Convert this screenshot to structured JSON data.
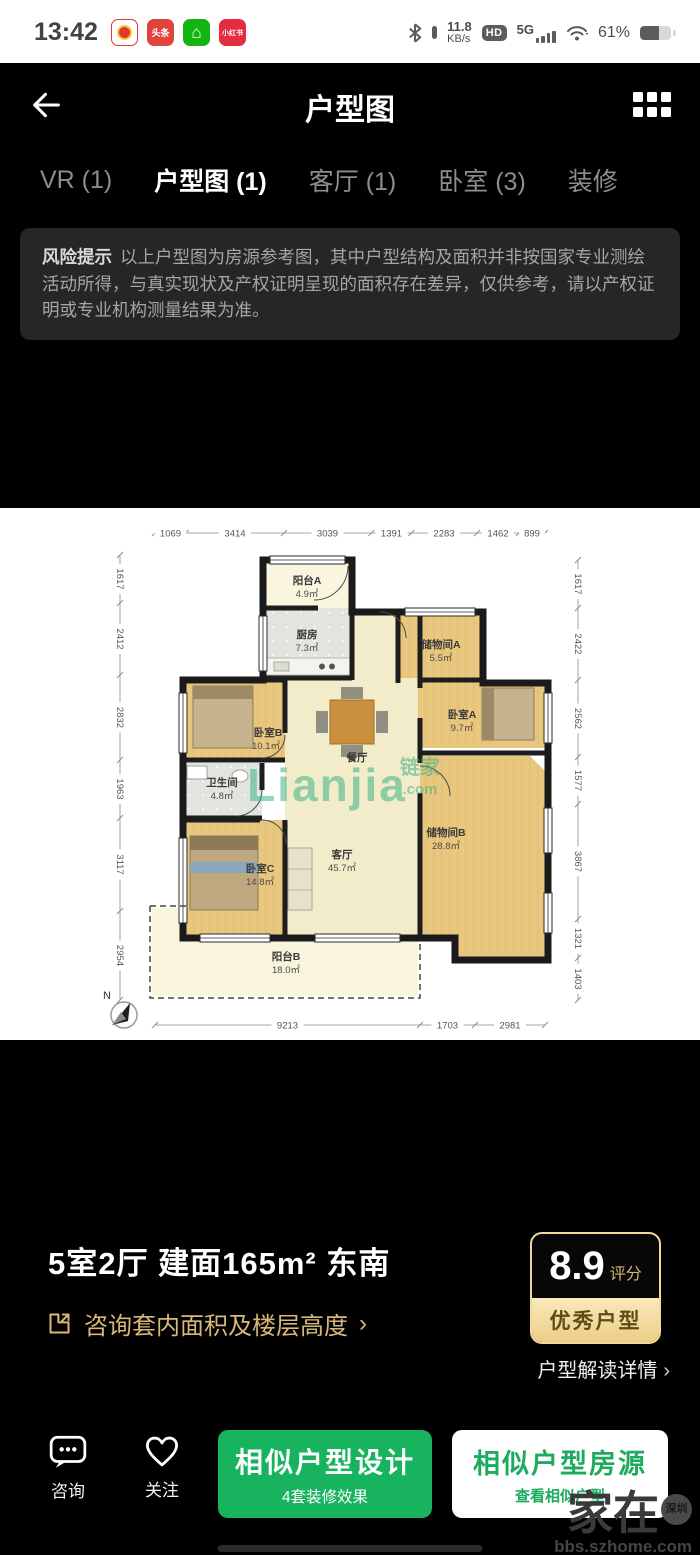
{
  "status_bar": {
    "time": "13:42",
    "app_icons": [
      {
        "name": "pinduoduo-icon",
        "label": ""
      },
      {
        "name": "toutiao-icon",
        "label": "头条"
      },
      {
        "name": "home-app-icon",
        "label": "⌂"
      },
      {
        "name": "xiaohongshu-icon",
        "label": "小红书"
      }
    ],
    "net_speed_value": "11.8",
    "net_speed_unit": "KB/s",
    "hd_badge": "HD",
    "network_type": "5G",
    "battery_percent": "61%"
  },
  "header": {
    "title": "户型图"
  },
  "tabs": [
    {
      "label": "VR (1)",
      "active": false
    },
    {
      "label": "户型图 (1)",
      "active": true
    },
    {
      "label": "客厅 (1)",
      "active": false
    },
    {
      "label": "卧室 (3)",
      "active": false
    },
    {
      "label": "装修",
      "active": false
    }
  ],
  "risk_notice": {
    "title": "风险提示",
    "body": "以上户型图为房源参考图，其中户型结构及面积并非按国家专业测绘活动所得，与真实现状及产权证明呈现的面积存在差异，仅供参考，请以产权证明或专业机构测量结果为准。"
  },
  "floorplan": {
    "north_label": "N",
    "watermark": {
      "brand": "Lianjia",
      "cn": "链家",
      "domain": ".com"
    },
    "rooms": [
      {
        "name": "阳台A",
        "area": "4.9㎡"
      },
      {
        "name": "厨房",
        "area": "7.3㎡"
      },
      {
        "name": "储物间A",
        "area": "5.5㎡"
      },
      {
        "name": "卧室B",
        "area": "10.1㎡"
      },
      {
        "name": "卧室A",
        "area": "9.7㎡"
      },
      {
        "name": "餐厅",
        "area": ""
      },
      {
        "name": "卫生间",
        "area": "4.8㎡"
      },
      {
        "name": "客厅",
        "area": "45.7㎡"
      },
      {
        "name": "储物间B",
        "area": "28.8㎡"
      },
      {
        "name": "卧室C",
        "area": "14.8㎡"
      },
      {
        "name": "阳台B",
        "area": "18.0㎡"
      }
    ],
    "dims_top": [
      "1069",
      "3414",
      "3039",
      "1391",
      "2283",
      "1462",
      "899"
    ],
    "dims_left": [
      "1617",
      "2412",
      "2832",
      "1963",
      "3117",
      "2954"
    ],
    "dims_right": [
      "1617",
      "2422",
      "2562",
      "1577",
      "3867",
      "1321",
      "1403"
    ],
    "dims_bottom": [
      "9213",
      "1703",
      "2981"
    ]
  },
  "summary": {
    "title": "5室2厅 建面165m² 东南",
    "consult_link": "咨询套内面积及楼层高度",
    "chevron": "›"
  },
  "rating": {
    "score": "8.9",
    "score_label": "评分",
    "badge": "优秀户型",
    "detail_link": "户型解读详情",
    "chevron": "›"
  },
  "bottom_bar": {
    "consult_label": "咨询",
    "follow_label": "关注",
    "primary": {
      "title": "相似户型设计",
      "subtitle": "4套装修效果"
    },
    "secondary": {
      "title": "相似户型房源",
      "subtitle": "查看相似户型"
    }
  },
  "site_watermark": {
    "name": "家在",
    "city": "深圳",
    "url": "bbs.szhome.com"
  },
  "colors": {
    "brand_green": "#17b35e",
    "gold": "#d8b878",
    "watermark_green": "#3db384"
  }
}
